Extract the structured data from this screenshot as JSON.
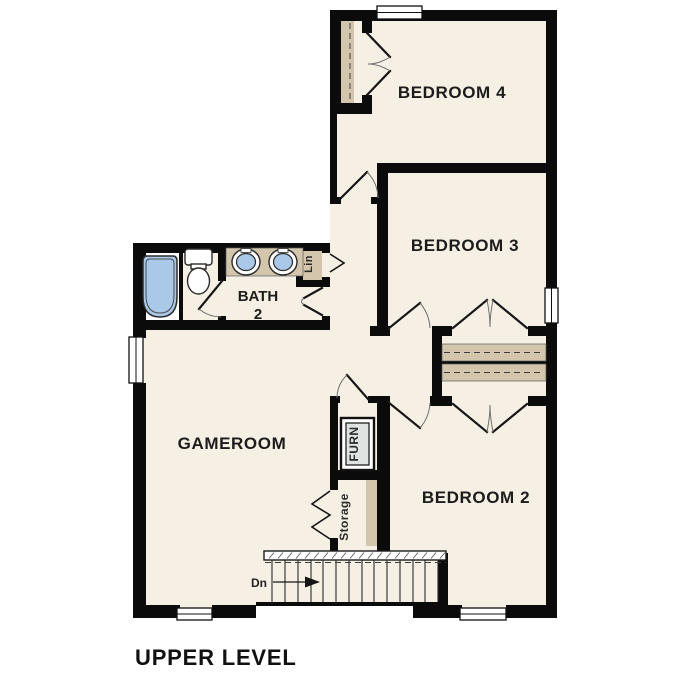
{
  "page": {
    "title": "UPPER LEVEL"
  },
  "rooms": {
    "bedroom4": "BEDROOM 4",
    "bedroom3": "BEDROOM 3",
    "bedroom2": "BEDROOM 2",
    "gameroom": "GAMEROOM",
    "bath": {
      "line1": "BATH",
      "line2": "2"
    },
    "linen": "Lin",
    "furnace": "FURN",
    "storage": "Storage"
  },
  "stairs": {
    "label": "Dn",
    "direction": "right",
    "tread_count": 13
  },
  "fixtures": {
    "bathtub": "bathtub",
    "toilet": "toilet",
    "vanity_sinks": "double vanity with two sinks",
    "furnace_unit": "furnace unit"
  },
  "windows": {
    "count": 5,
    "locations": [
      "top wall",
      "right wall",
      "left wall",
      "bottom-left wall",
      "bottom-right wall"
    ]
  },
  "colors": {
    "background": "#ffffff",
    "floor": "#f6f0e4",
    "wall": "#0b0b0b",
    "casework_tan": "#d3c6ac",
    "fixture_blue": "#aac9e8",
    "furnace_gray": "#dfe3e2"
  }
}
